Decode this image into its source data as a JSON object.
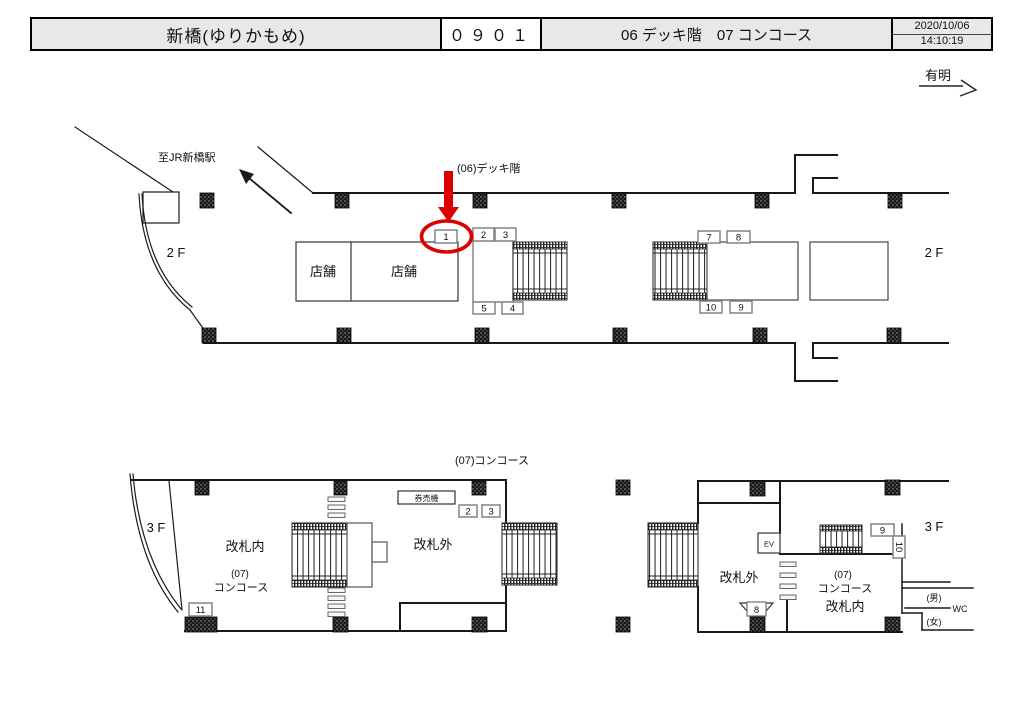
{
  "header": {
    "station": "新橋(ゆりかもめ)",
    "code": "０９０１",
    "floors": "06 デッキ階　07 コンコース",
    "date": "2020/10/06",
    "time": "14:10:19"
  },
  "direction": {
    "label": "有明"
  },
  "deck": {
    "title": "(06)デッキ階",
    "to_jr": "至JR新橋駅",
    "floor_left": "2 F",
    "floor_right": "2 F",
    "shop_left": "店舗",
    "shop_right": "店舗",
    "boxes": {
      "b1": "1",
      "b2": "2",
      "b3": "3",
      "b4": "4",
      "b5": "5",
      "b7": "7",
      "b8": "8",
      "b9": "9",
      "b10": "10"
    }
  },
  "conc": {
    "title": "(07)コンコース",
    "left": {
      "floor": "3 F",
      "inside": "改札内",
      "line1": "(07)",
      "line2": "コンコース",
      "outside": "改札外",
      "machine": "券売機",
      "b2": "2",
      "b3": "3",
      "b11": "11"
    },
    "right": {
      "floor": "3 F",
      "outside": "改札外",
      "line1": "(07)",
      "line2": "コンコース",
      "line3": "改札内",
      "ev": "EV",
      "men": "(男)",
      "women": "(女)",
      "wc": "WC",
      "b8": "8",
      "b9": "9",
      "b10": "10"
    }
  },
  "colors": {
    "accent_red": "#dd0000",
    "header_bg": "#e8e8e8",
    "line": "#1a1a1a"
  }
}
